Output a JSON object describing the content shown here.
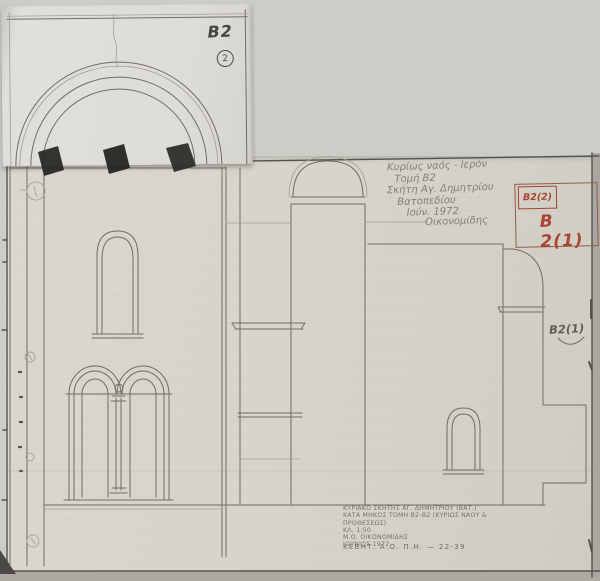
{
  "drawing_labels": {
    "patch_sheet_code": "B2",
    "patch_sheet_number": "2",
    "box_small": "Β2(2)",
    "box_large": "Β 2(1)",
    "wall_label": "Β2(1)"
  },
  "handwritten_note": {
    "lines": [
      "Κυρίως ναός - Ιερόν",
      "Τομή Β2",
      "Σκήτη Αγ. Δημητρίου",
      "Βατοπεδίου",
      "Ιούν. 1972",
      "Οικονομίδης"
    ]
  },
  "caption": {
    "lines": [
      "ΚΥΡΙΑΚΟ ΣΚΗΤΗΣ ΑΓ. ΔΗΜΗΤΡΙΟΥ (ΒΑΤ.)",
      "ΚΑΤΑ ΜΗΚΟΣ ΤΟΜΗ Β2-Β2 (ΚΥΡΙΩΣ ΝΑΟΥ & ΠΡΟΘΕΣΕΩΣ)",
      "ΚΛ. 1:50",
      "Μ.Ο. ΟΙΚΟΝΟΜΙΔΗΣ",
      "ΙΟΥΝΙΟΣ 1972"
    ],
    "archive_ref": "ΚΕΒΗΤ. Α.Ο. Π.Η. — 22-39"
  },
  "colors": {
    "red_ink": "#a8442f",
    "pencil": "#6f6d66",
    "paper": "#d6d3cb",
    "patch_paper": "#dedcd6"
  }
}
